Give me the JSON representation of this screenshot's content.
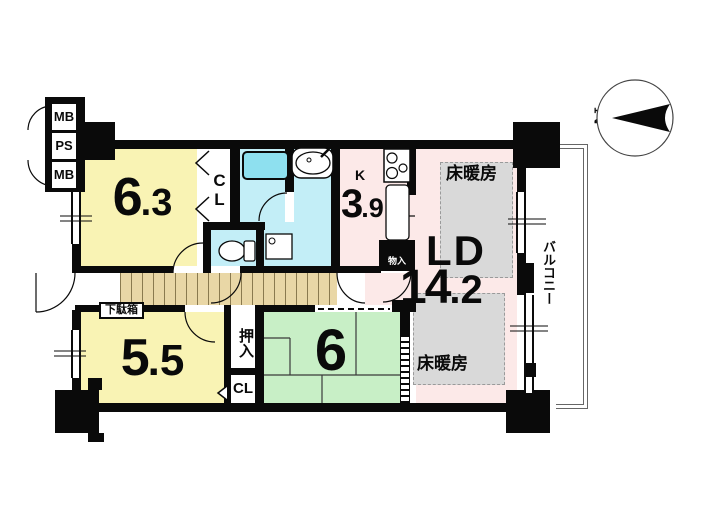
{
  "canvas": {
    "width": 705,
    "height": 525
  },
  "colors": {
    "wall": "#0a0a0a",
    "room_yellow": "#f9f3b4",
    "room_cyan": "#c3eef7",
    "bathtub_cyan": "#8ee0ef",
    "room_pink": "#fce9e8",
    "room_green": "#c8efc6",
    "corridor_wood": "#e9d7a6",
    "wood_line": "#8a7a4f",
    "heating_gray": "#d9d9d9",
    "rail_gray": "#666666"
  },
  "compass": {
    "north_label": "N"
  },
  "shafts": {
    "mb_top": "MB",
    "ps": "PS",
    "mb_bottom": "MB"
  },
  "rooms": {
    "western1": {
      "size_int": "6",
      "size_frac": ".3"
    },
    "western2": {
      "size_int": "5",
      "size_frac": ".5"
    },
    "japanese": {
      "size_int": "6",
      "size_frac": ""
    },
    "living": {
      "label": "LD",
      "size_int": "14",
      "size_frac": ".2"
    },
    "kitchen": {
      "label": "K",
      "size_int": "3",
      "size_frac": ".9"
    }
  },
  "storage": {
    "cl_upper": "CL",
    "cl_lower": "CL",
    "oshiire": "押入",
    "monoire": "物入",
    "getabako": "下駄箱"
  },
  "features": {
    "floor_heating_upper": "床暖房",
    "floor_heating_lower": "床暖房",
    "balcony": "バルコニー"
  }
}
